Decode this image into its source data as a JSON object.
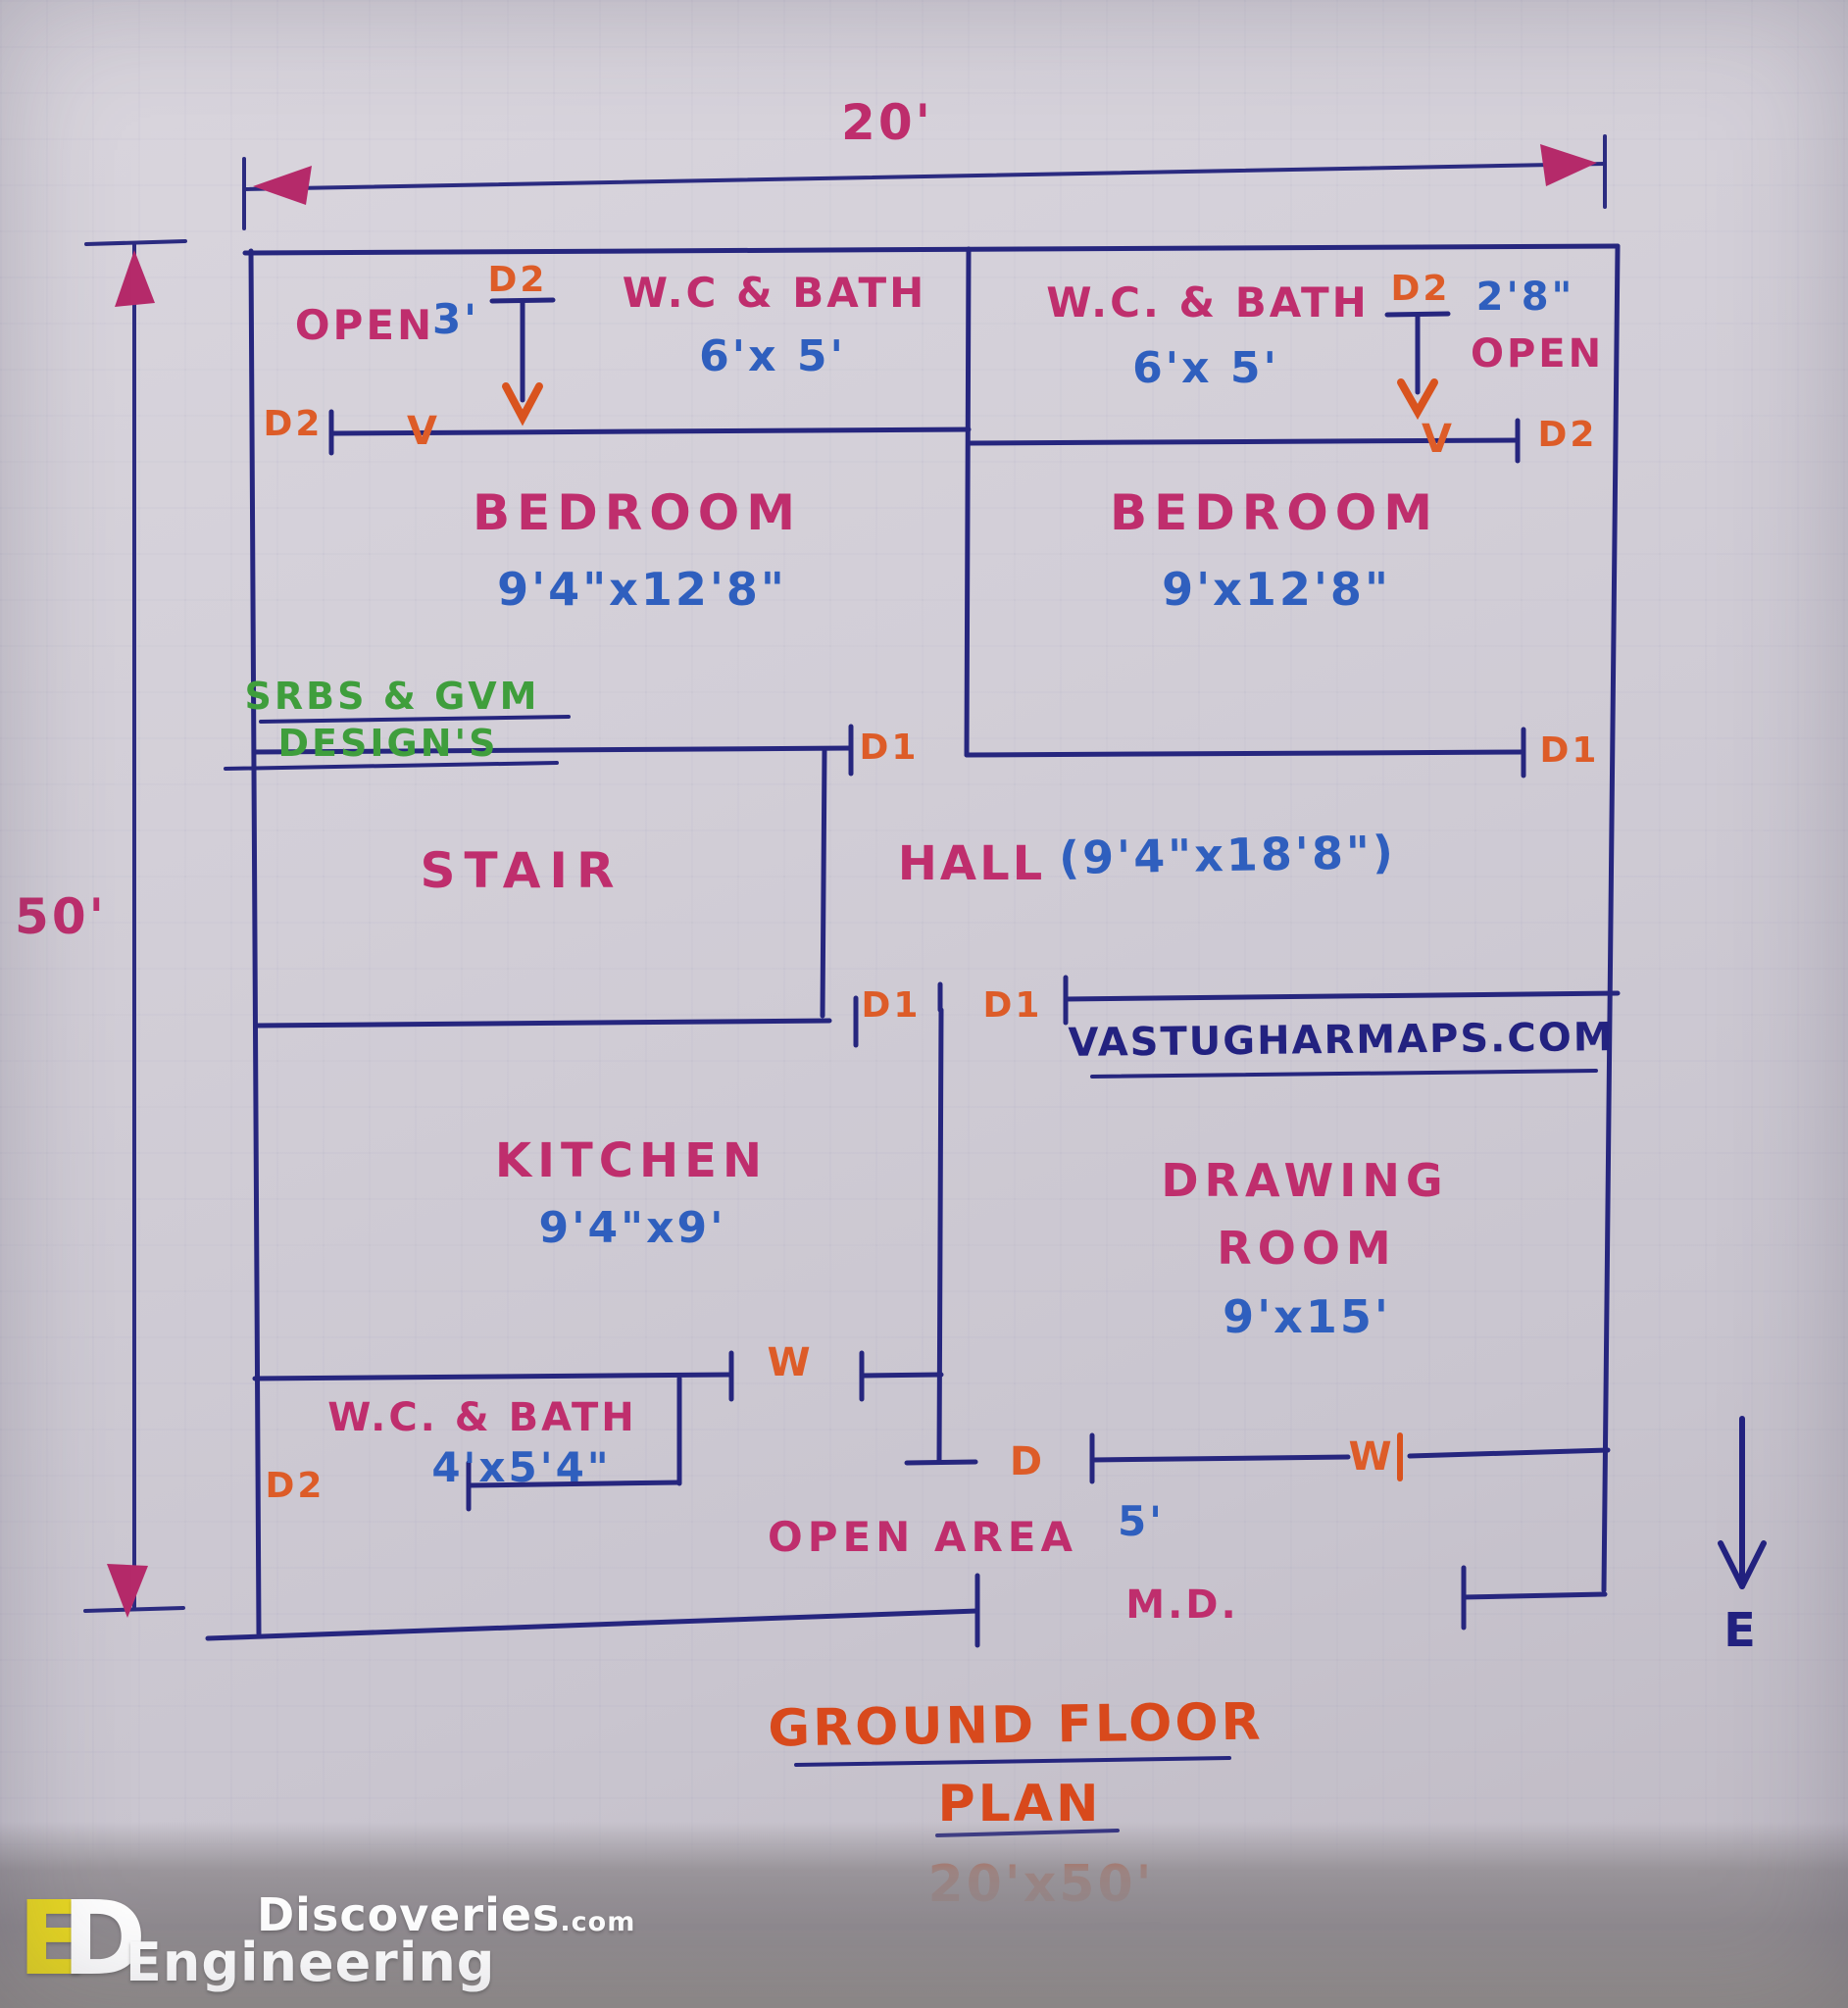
{
  "dims": {
    "width": "20'",
    "height": "50'"
  },
  "top": {
    "open_left": "OPEN",
    "open_left_size": "3'",
    "d2_top_left": "D2",
    "d2_wall_left": "D2",
    "vent_left": "V",
    "wc_left_name": "W.C & BATH",
    "wc_left_size": "6'x 5'",
    "wc_right_name": "W.C. & BATH",
    "wc_right_size": "6'x 5'",
    "d2_top_right": "D2",
    "open_right_size": "2'8\"",
    "open_right": "OPEN",
    "vent_right": "V",
    "d2_wall_right": "D2"
  },
  "bedrooms": {
    "left_name": "BEDROOM",
    "left_size": "9'4\"x12'8\"",
    "right_name": "BEDROOM",
    "right_size": "9'x12'8\"",
    "d1_left": "D1",
    "d1_right": "D1"
  },
  "designer": {
    "line1": "SRBS & GVM",
    "line2": "DESIGN'S"
  },
  "hall": {
    "stair": "STAIR",
    "name": "HALL",
    "size": "(9'4\"x18'8\")",
    "d1_left": "D1",
    "d1_right": "D1",
    "watermark": "VASTUGHARMAPS.COM"
  },
  "lower": {
    "kitchen_name": "KITCHEN",
    "kitchen_size": "9'4\"x9'",
    "drawing_name1": "DRAWING",
    "drawing_name2": "ROOM",
    "drawing_size": "9'x15'",
    "window_kitchen": "W",
    "window_drawing": "W",
    "wc_name": "W.C. & BATH",
    "wc_size": "4'x5'4\"",
    "d2_wc": "D2",
    "d_hall": "D",
    "open_area": "OPEN AREA",
    "open_area_size": "5'",
    "main_door": "M.D."
  },
  "compass": "E",
  "title": {
    "line1": "GROUND FLOOR",
    "line2": "PLAN",
    "line3": "20'x50'"
  },
  "branding": {
    "mono_e": "E",
    "mono_d": "D",
    "top": "Discoveries",
    "top_suffix": ".com",
    "bottom": "Engineering"
  },
  "colors": {
    "wall_navy": "#26267e",
    "room_pink": "#bf2e6d",
    "size_blue": "#2f5fbe",
    "door_orange": "#dd5c28",
    "designer_green": "#3f9e3c",
    "title_orange": "#d8491c",
    "logo_yellow": "#e8d821"
  }
}
